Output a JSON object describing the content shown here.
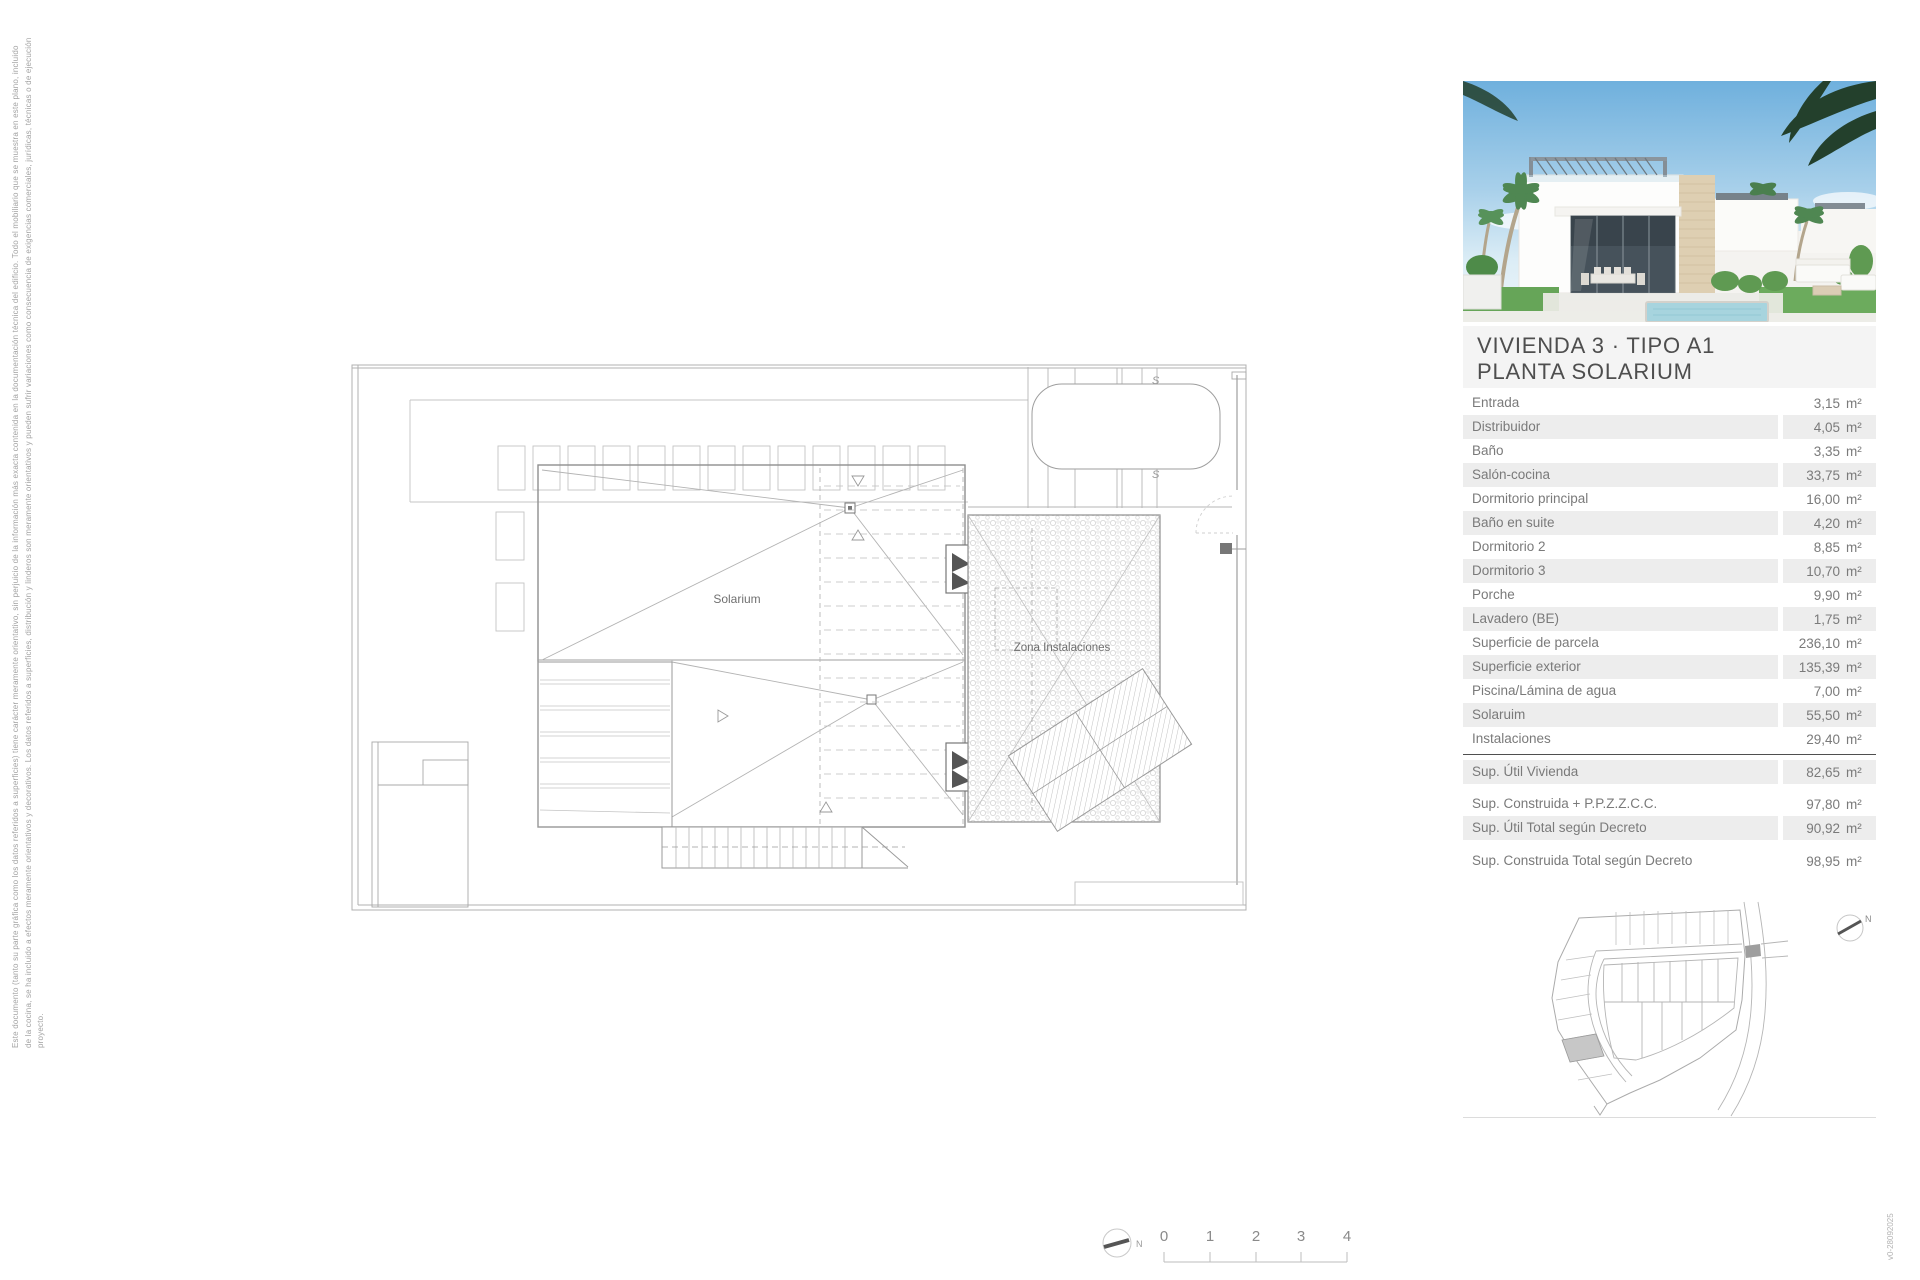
{
  "disclaimer": {
    "line1": "Este documento (tanto su parte gráfica como los datos referidos a superficies) tiene carácter meramente orientativo, sin perjuicio de la información más exacta contenida en la documentación técnica del edificio. Todo el mobiliario que se muestra en este plano, incluido",
    "line2": "de la cocina, se ha incluido a efectos meramente orientativos y decorativos. Los datos referidos a superficies, distribución y linderos son meramente orientativos y pueden sufrir variaciones como consecuencia de exigencias comerciales, jurídicas, técnicas o de ejecución",
    "line3": "proyecto."
  },
  "version_label": "v0-28092025",
  "panel": {
    "title_line1": "VIVIENDA 3 · TIPO A1",
    "title_line2": "PLANTA SOLARIUM",
    "unit": "m²",
    "rooms": [
      {
        "label": "Entrada",
        "value": "3,15"
      },
      {
        "label": "Distribuidor",
        "value": "4,05"
      },
      {
        "label": "Baño",
        "value": "3,35"
      },
      {
        "label": "Salón-cocina",
        "value": "33,75"
      },
      {
        "label": "Dormitorio principal",
        "value": "16,00"
      },
      {
        "label": "Baño en suite",
        "value": "4,20"
      },
      {
        "label": "Dormitorio 2",
        "value": "8,85"
      },
      {
        "label": "Dormitorio 3",
        "value": "10,70"
      },
      {
        "label": "Porche",
        "value": "9,90"
      },
      {
        "label": "Lavadero (BE)",
        "value": "1,75"
      },
      {
        "label": "Superficie de parcela",
        "value": "236,10"
      },
      {
        "label": "Superficie exterior",
        "value": "135,39"
      },
      {
        "label": "Piscina/Lámina de agua",
        "value": "7,00"
      },
      {
        "label": "Solaruim",
        "value": "55,50"
      },
      {
        "label": "Instalaciones",
        "value": "29,40"
      }
    ],
    "totals": [
      {
        "label": "Sup. Útil Vivienda",
        "value": "82,65"
      },
      {
        "label": "Sup. Construida + P.P.Z.Z.C.C.",
        "value": "97,80"
      },
      {
        "label": "Sup. Útil Total según Decreto",
        "value": "90,92"
      },
      {
        "label": "Sup. Construida Total según Decreto",
        "value": "98,95"
      }
    ]
  },
  "plan": {
    "label_solarium": "Solarium",
    "label_zona": "Zona Instalaciones",
    "section_mark": "S"
  },
  "scalebar": {
    "labels": [
      "0",
      "1",
      "2",
      "3",
      "4"
    ],
    "north": "N"
  },
  "map": {
    "north": "N"
  },
  "colors": {
    "row_gray": "#ededed",
    "title_bg": "#f4f4f4",
    "divider_dark": "#4f4f4f",
    "line_gray": "#b0b0b0",
    "text_gray": "#7a7a7a"
  }
}
